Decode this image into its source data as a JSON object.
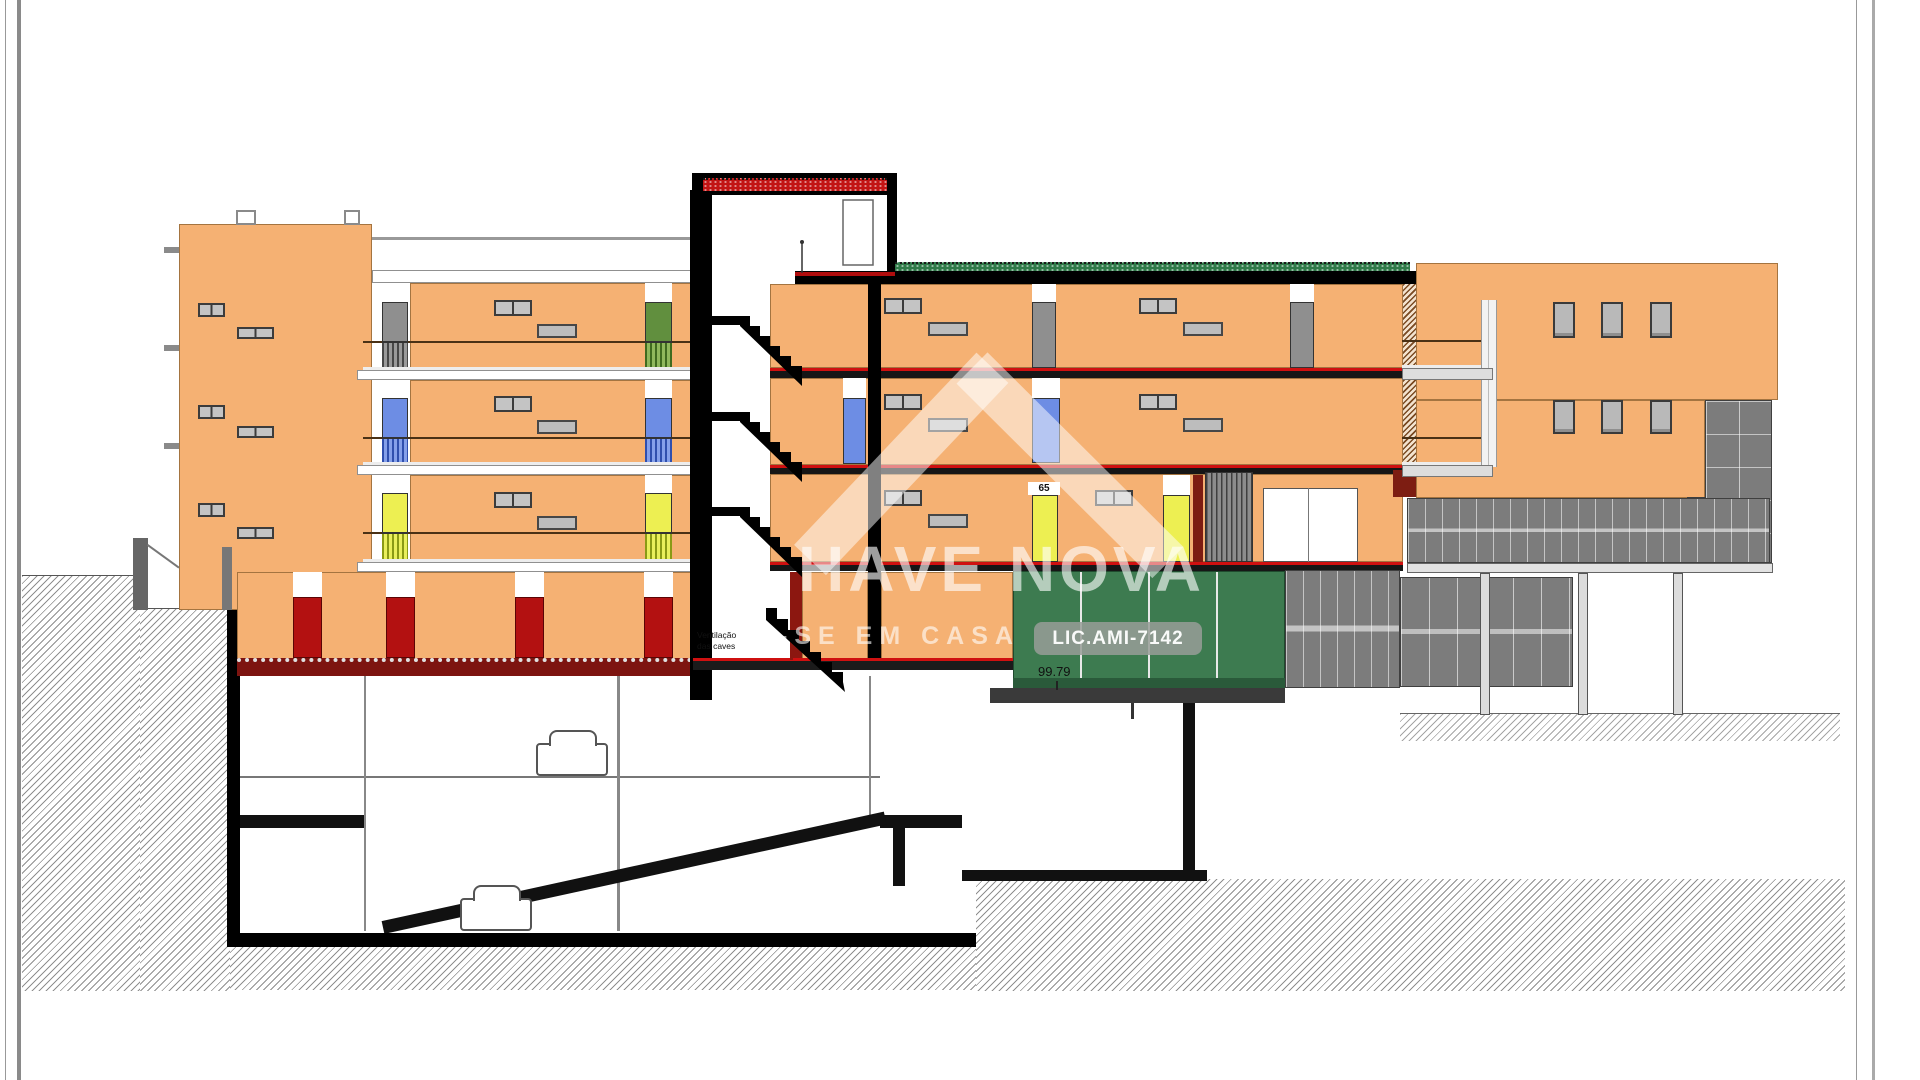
{
  "labels": {
    "ventilation_caves_line1": "Ventilação",
    "ventilation_caves_line2": "das caves",
    "apartment_number": "65",
    "level_elevation": "99.79"
  },
  "watermark": {
    "brand_text": "HAVE NOVA",
    "slogan_text": "A-SE EM CASA",
    "license_text": "LIC.AMI-7142"
  },
  "colors": {
    "facade_orange": "#F5B173",
    "door_gray": "#8F8F8F",
    "door_blue": "#6D8DE4",
    "door_yellow": "#EDEF52",
    "door_green": "#618F3E",
    "garage_door_red": "#B31111",
    "garage_door_green": "#3D7B50",
    "roof_green": "#2F7A48",
    "slab_red": "#CF1010",
    "railing_brown": "#C99A66",
    "curtain_gray": "#7C7C7C"
  },
  "drawing": {
    "left_building_floor_door_colors": [
      "green",
      "blue",
      "yellow"
    ],
    "left_building_garage_door_count": 4,
    "mid_building_floor_door_colors": [
      "gray",
      "blue",
      "yellow"
    ],
    "garage_green_panel_count": 4,
    "underground_parking_levels": 2,
    "car_count": 2
  }
}
